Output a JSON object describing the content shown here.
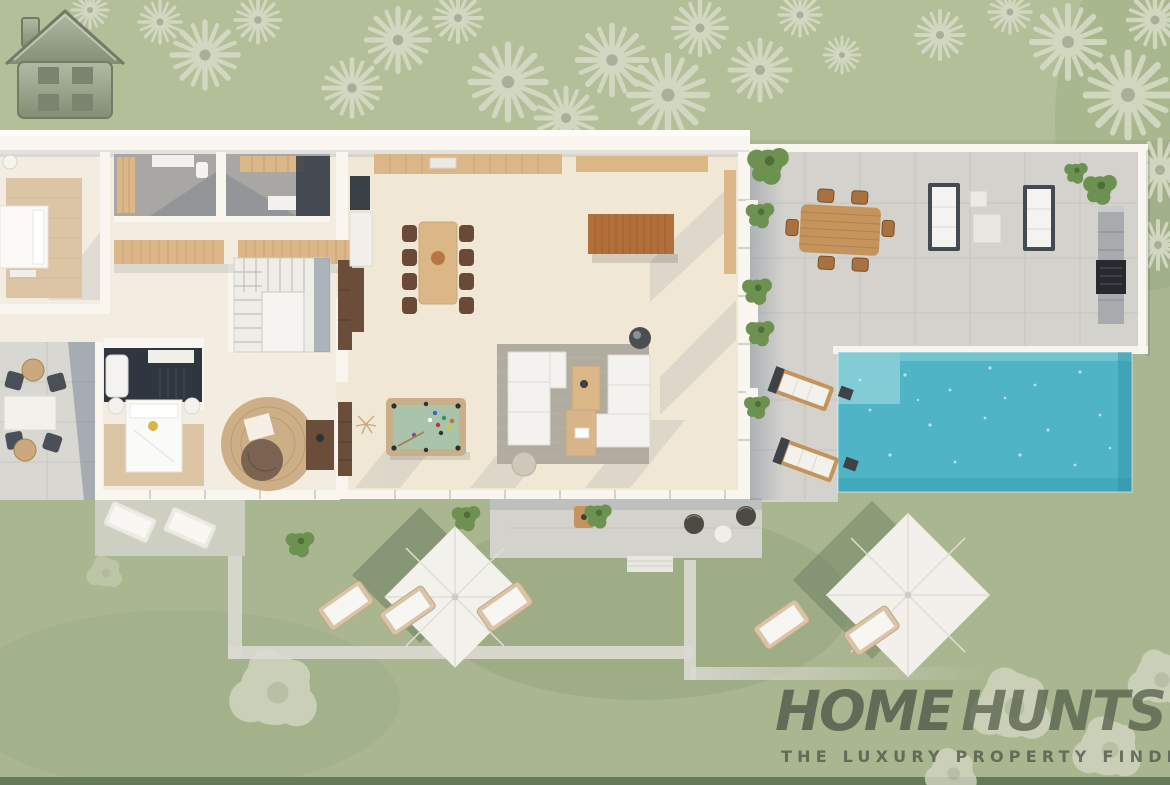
{
  "watermark": {
    "brand_part1": "HOME",
    "brand_part2": "HUNTS",
    "tagline": "THE LUXURY PROPERTY FINDERS"
  },
  "icons": {
    "watermark_logo": "house-icon",
    "vegetation": [
      "palm-tree-icon",
      "tree-icon",
      "shrub-icon"
    ]
  },
  "palette": {
    "grass": "#a9b68f",
    "grass_light": "#bcc7a1",
    "grass_dark": "#8ca075",
    "tree_pale": "#d3d8c2",
    "tree_green": "#6d9150",
    "path": "#dbdad3",
    "terrace": "#d3d2cd",
    "terrace_line": "#c3c2bc",
    "wall": "#f9f6f0",
    "floor": "#f3ece0",
    "floor_warm": "#f0e7d4",
    "rug_tan": "#dcc5a4",
    "rug_gray": "#b1aba0",
    "wood_light": "#dbb687",
    "wood_mid": "#c5935c",
    "wood_rich": "#b26f3a",
    "wood_dark": "#6b4e3a",
    "pool": "#4fb5c6",
    "pool_shallow": "#93d4da",
    "pool_dark": "#2f93a8",
    "shadow_blue": "#5c6c82",
    "felt": "#aac3ab",
    "logo": "#4d574a",
    "logo2": "#58624f",
    "logo_tag": "#4e5949"
  },
  "scene": {
    "type": "aerial-3d-floor-plan-render",
    "areas": [
      "master-bedroom",
      "bathrooms",
      "stairwell",
      "bedroom-2",
      "en-suite-bathroom",
      "study-nook",
      "open-plan-kitchen",
      "dining-area",
      "living-area",
      "billiards-area",
      "west-patio",
      "pool-terrace",
      "swimming-pool",
      "outdoor-dining",
      "outdoor-kitchen",
      "lawn-with-parasols"
    ]
  }
}
